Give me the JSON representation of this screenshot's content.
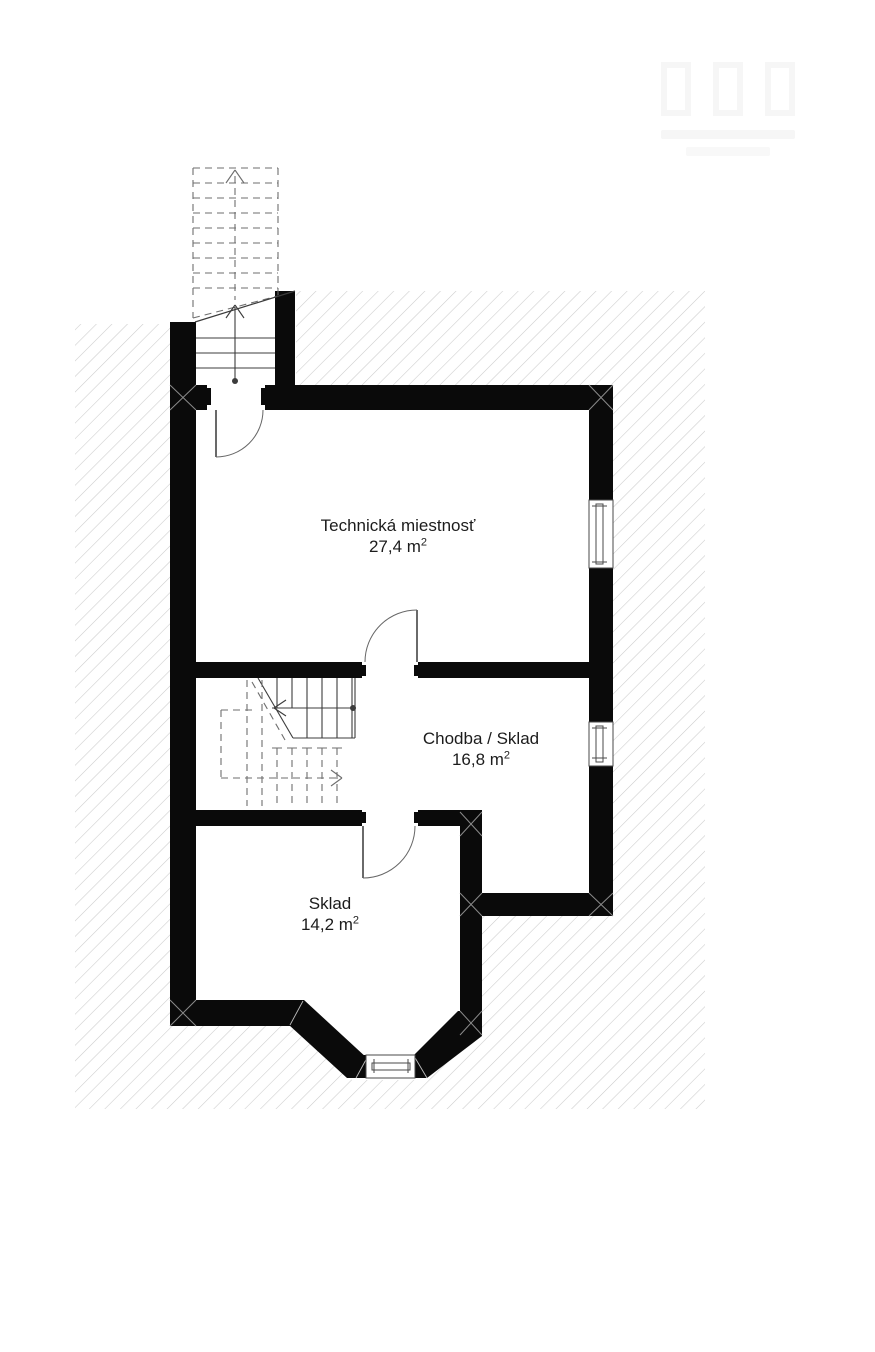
{
  "plan_type": "basement floor plan",
  "rooms": [
    {
      "id": "technicka-miestnost",
      "name": "Technická miestnosť",
      "area": "27,4 m²",
      "area_value": "27,4 m",
      "area_sup": "2"
    },
    {
      "id": "chodba-sklad",
      "name": "Chodba / Sklad",
      "area": "16,8 m²",
      "area_value": "16,8 m",
      "area_sup": "2"
    },
    {
      "id": "sklad",
      "name": "Sklad",
      "area": "14,2 m²",
      "area_value": "14,2 m",
      "area_sup": "2"
    }
  ],
  "features": {
    "doors": 3,
    "windows": 3,
    "stairs": [
      "exterior-stair-up-dashed",
      "interior-stair-lower"
    ],
    "ground_hatch": true
  },
  "watermark": {
    "visible": true,
    "text_legible": false
  },
  "colors": {
    "wall": "#0a0a0a",
    "hatch_line": "#cbcbcb",
    "stair_line": "#3c3c3c",
    "dashed_line": "#6e6e6e",
    "door_arc": "#666666",
    "window_frame": "#4a4a4a",
    "corner_mark": "#8a8a8a",
    "text": "#1c1c1c"
  }
}
